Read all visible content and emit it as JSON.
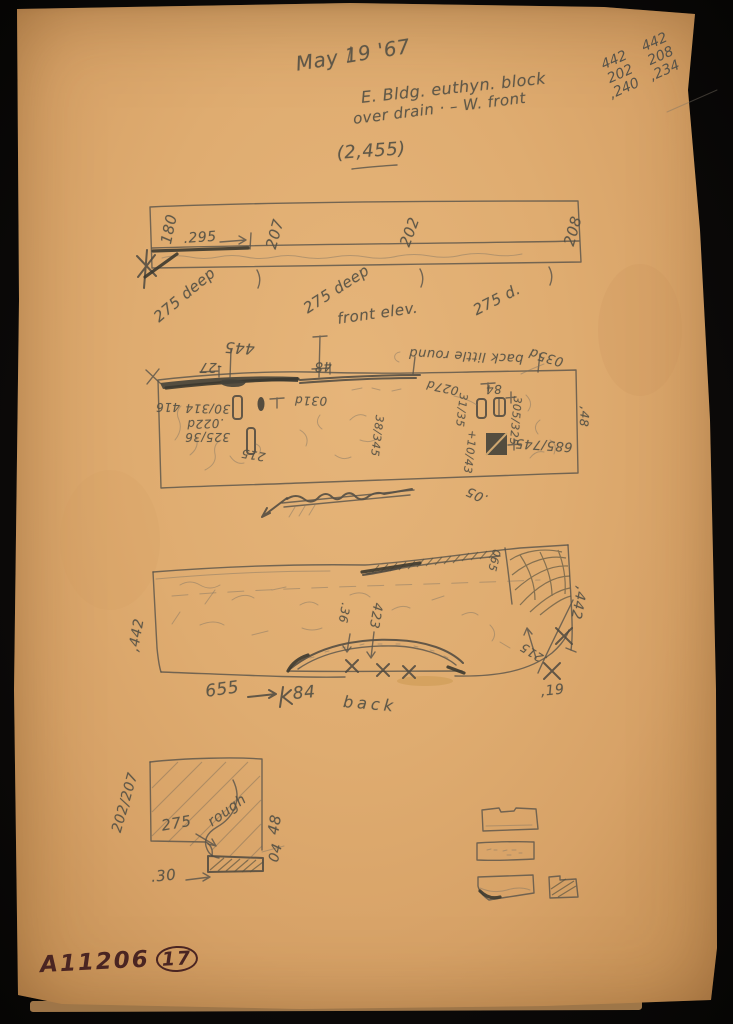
{
  "document": {
    "date": "May 19 '67",
    "subject_line1": "E. Bldg. euthyn. block",
    "subject_line2": "over drain · – W. front",
    "catalog_ref": "(2,455)"
  },
  "corner_calc": {
    "col1": [
      "442",
      "202",
      ",240"
    ],
    "col2": [
      "442",
      "208",
      ",234"
    ]
  },
  "plan_view": {
    "segment_widths": [
      "180",
      "207",
      "202",
      "208"
    ],
    "edge_offset": ".295",
    "depth_left": "275 deep",
    "depth_mid": "275 deep",
    "depth_right": "275 d.",
    "caption": "front elev."
  },
  "front_elev": {
    "total_width": "445",
    "minus_left": "-27",
    "tick_width": "48",
    "back_note": "back little round",
    "depth_note": "035d",
    "left_height": "416",
    "dim_30_314": "30/314",
    "dim_022d": ".022d",
    "dim_325_36": "325/36",
    "dim_215": "215",
    "dim_031d": "031d",
    "dim_38_345": "38/345",
    "dim_027d": "027d",
    "dim_84": "84",
    "dim_31_35": "31/35",
    "dim_305_325": "305/325",
    "dim_10_43": "+10/43",
    "dim_685_745": "685/745",
    "right_height": ",48",
    "bottom_note": ".05",
    "struck_note": "back (struck out)"
  },
  "back_view": {
    "left_height": ",442",
    "right_height": ",442",
    "band_dim": "065",
    "arch_rise": ".36",
    "arch_width": "423",
    "diag_dim": ".215",
    "corner_dim": ",19",
    "bottom_length": "655",
    "bottom_offset": "84",
    "caption": "back"
  },
  "section_detail": {
    "face_dims": "202/207",
    "inner_dim": "275",
    "surface_note": "rough",
    "right_upper": "48",
    "right_lower": "04",
    "bottom_dim": ".30"
  },
  "thumbnails_note": "faint pencil detail sketches",
  "footer": {
    "negative_number": "A11206",
    "sheet_number": "17"
  }
}
